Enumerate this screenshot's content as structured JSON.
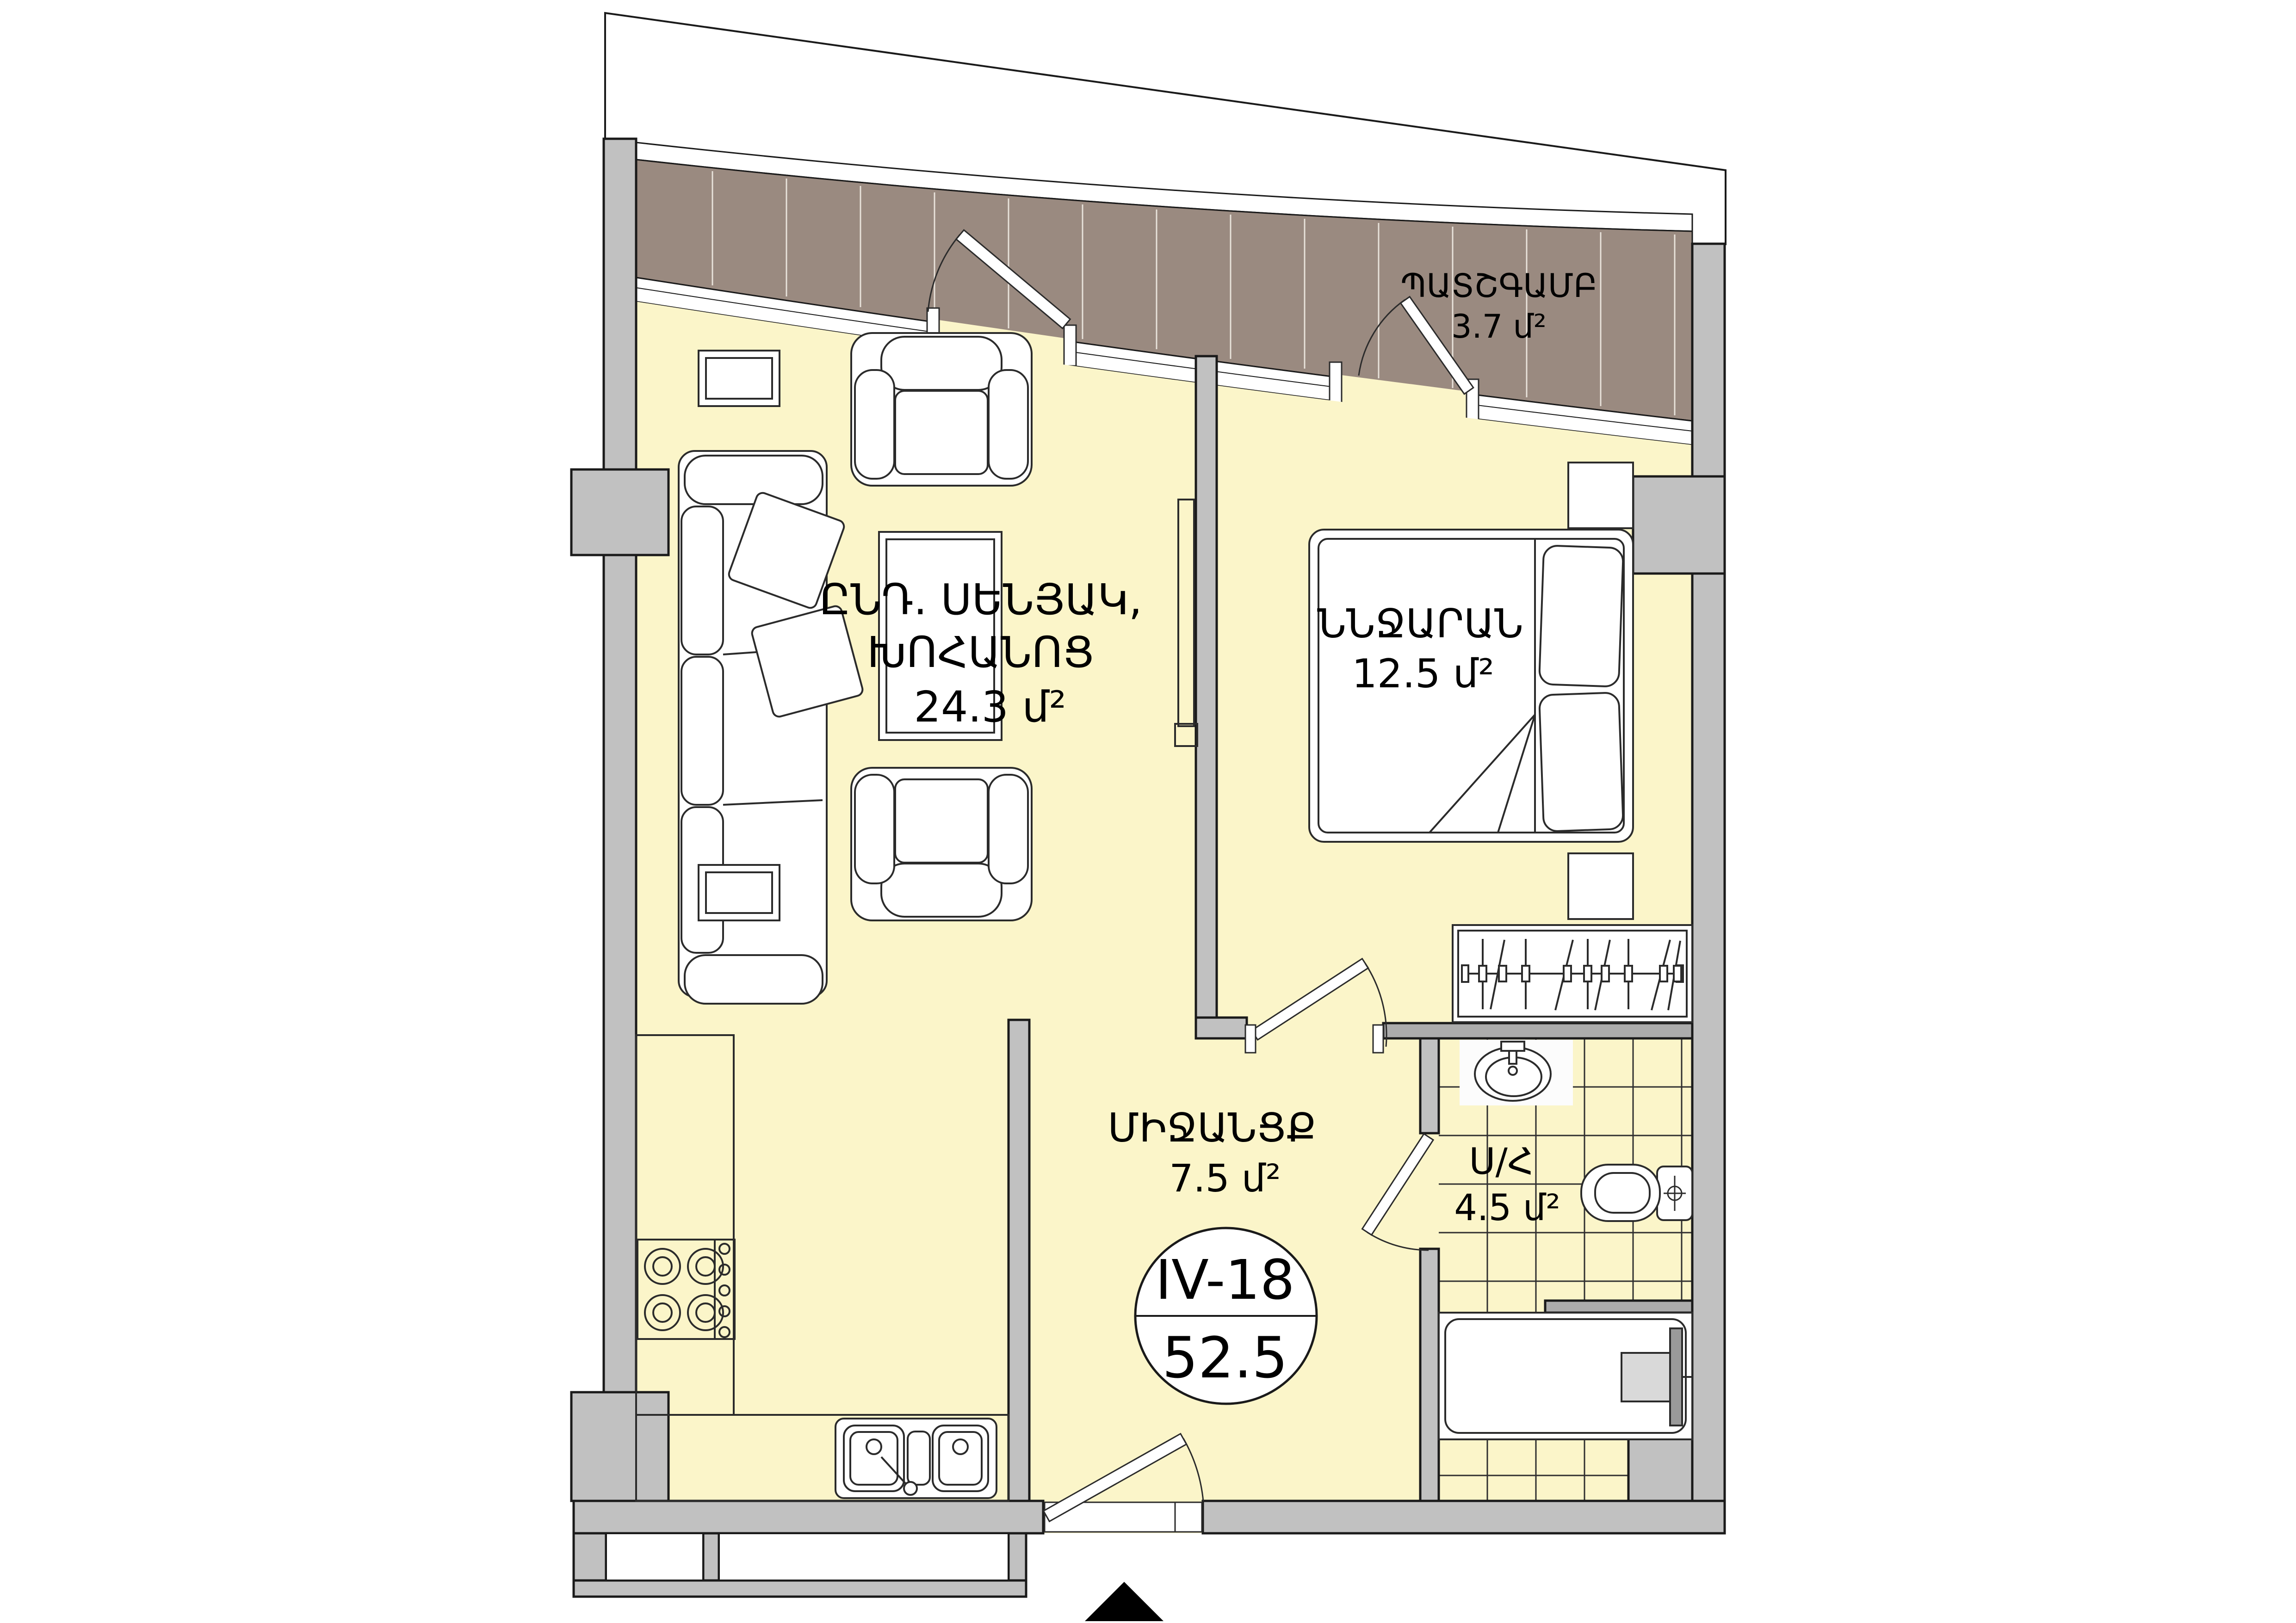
{
  "plan": {
    "unit_badge": {
      "unit": "IV-18",
      "total_area": "52.5"
    },
    "rooms": {
      "balcony": {
        "name": "ՊԱՏՇԳԱՄԲ",
        "area": "3.7 մ²"
      },
      "living_kitchen": {
        "name_line1": "ԸՆԴ. ՍԵՆՅԱԿ,",
        "name_line2": "ԽՈՀԱՆՈՑ",
        "area": "24.3 մ²"
      },
      "bedroom": {
        "name": "ՆՆՋԱՐԱՆ",
        "area": "12.5 մ²"
      },
      "hallway": {
        "name": "ՄԻՋԱՆՑՔ",
        "area": "7.5 մ²"
      },
      "bathroom": {
        "name": "Ս/Հ",
        "area": "4.5 մ²"
      }
    },
    "colors": {
      "floor": "#fbf5c9",
      "wall": "#c1c1c1",
      "wall_dark": "#acacac",
      "balcony_deck": "#9a8a80",
      "outline": "#1a1a1a"
    }
  }
}
